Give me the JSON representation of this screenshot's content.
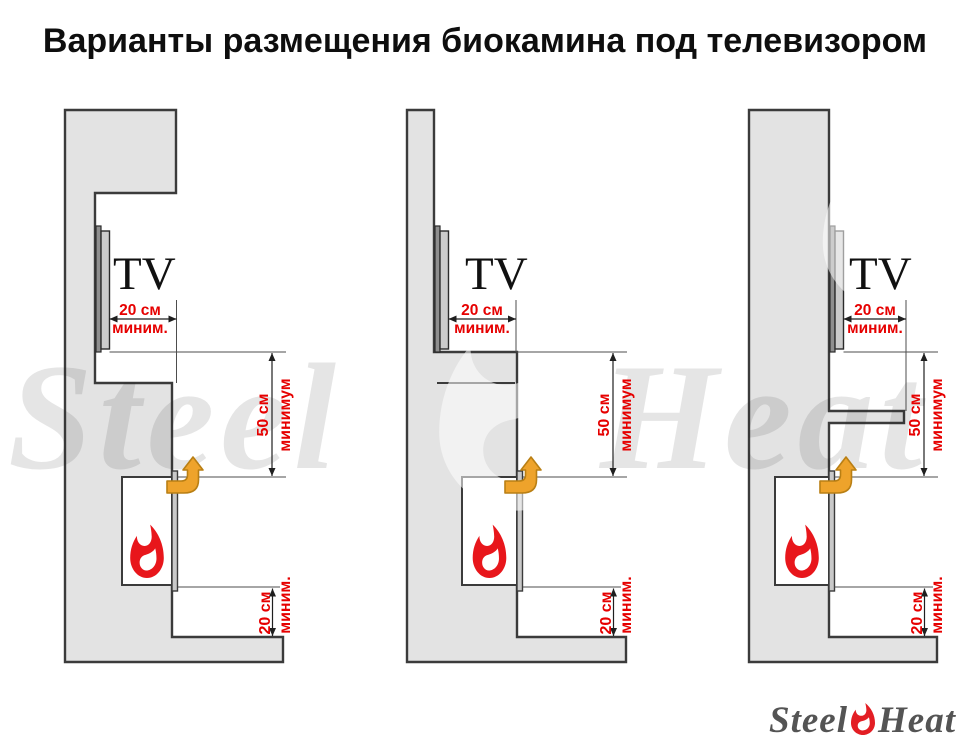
{
  "title": "Варианты размещения биокамина под телевизором",
  "labels": {
    "tv": "TV"
  },
  "dimensions": {
    "tv_side_clearance": {
      "value": "20 см",
      "qualifier": "миним."
    },
    "fireplace_to_tv": {
      "value": "50 см",
      "qualifier": "минимум"
    },
    "fireplace_to_base": {
      "value": "20 см",
      "qualifier": "миним."
    }
  },
  "watermark": {
    "steel": "Steel",
    "heat": "Heat"
  },
  "logo": {
    "steel": "Steel",
    "heat": "Heat"
  },
  "colors": {
    "annotation_red": "#e60000",
    "flame_red": "#e8161b",
    "arrow_orange": "#eea32b",
    "arrow_outline": "#b97f14",
    "wall_fill": "#e3e3e3",
    "wall_outline": "#3b3b3b",
    "logo_flame_red": "#e31e24",
    "logo_text_gray": "#545454"
  }
}
